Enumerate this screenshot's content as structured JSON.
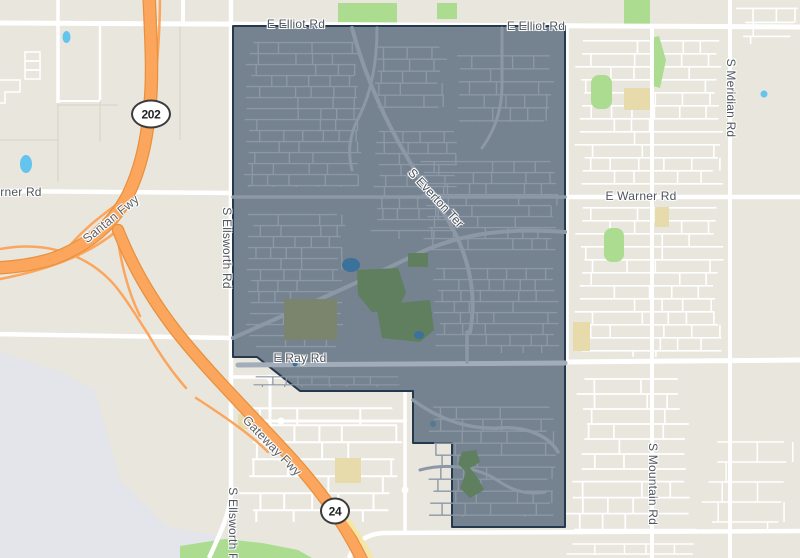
{
  "title": "Map with highlighted boundary area",
  "map": {
    "width": 800,
    "height": 558,
    "colors": {
      "base": "#e9e6de",
      "airport_gray": "#e4e5ea",
      "road_white": "#ffffff",
      "parcel_line": "#d9d5c9",
      "park_green": "#abdc90",
      "school_tan": "#e8dbab",
      "water_blue": "#63c4ee",
      "freeway_fill": "#fba65c",
      "freeway_casing": "#e8913d",
      "yellow_road": "#f6e7a0",
      "boundary_fill": "rgba(77,96,117,0.75)",
      "boundary_stroke": "#24384e",
      "inner_street": "#8c98a5",
      "inner_road_major": "#a2adb9",
      "inner_park": "#5f7f5f",
      "inner_park_olive": "#7b856e",
      "inner_pond": "#3b719a"
    },
    "boundary": {
      "name": "highlighted-district-boundary",
      "points": [
        [
          233,
          26
        ],
        [
          565,
          26
        ],
        [
          565,
          527
        ],
        [
          452,
          527
        ],
        [
          452,
          443
        ],
        [
          413,
          443
        ],
        [
          413,
          391
        ],
        [
          300,
          391
        ],
        [
          257,
          357
        ],
        [
          233,
          357
        ]
      ]
    },
    "labels": [
      {
        "id": "road-label-e-elliot-rd-west",
        "text": "E Elliot Rd",
        "x": 296,
        "y": 24,
        "rot": 0,
        "kind": "road"
      },
      {
        "id": "road-label-e-elliot-rd-east",
        "text": "E Elliot Rd",
        "x": 536,
        "y": 26,
        "rot": 0,
        "kind": "road"
      },
      {
        "id": "road-label-warner-rd-west",
        "text": "Warner Rd",
        "x": 12,
        "y": 192,
        "rot": 0,
        "kind": "road"
      },
      {
        "id": "road-label-e-warner-rd",
        "text": "E Warner Rd",
        "x": 641,
        "y": 196,
        "rot": 0,
        "kind": "road"
      },
      {
        "id": "road-label-e-ray-rd",
        "text": "E Ray Rd",
        "x": 300,
        "y": 358,
        "rot": 0,
        "kind": "road"
      },
      {
        "id": "road-label-s-everton-ter",
        "text": "S Everton Ter",
        "x": 436,
        "y": 198,
        "rot": 47,
        "kind": "road"
      },
      {
        "id": "freeway-label-santan-fwy",
        "text": "Santan Fwy",
        "x": 111,
        "y": 219,
        "rot": -39,
        "kind": "freeway"
      },
      {
        "id": "freeway-label-gateway-fwy",
        "text": "Gateway Fwy",
        "x": 272,
        "y": 446,
        "rot": 46,
        "kind": "freeway"
      },
      {
        "id": "road-label-s-ellsworth-rd-mid",
        "text": "S Ellsworth Rd",
        "x": 227,
        "y": 248,
        "rot": 0,
        "kind": "road",
        "vertical": true
      },
      {
        "id": "road-label-s-ellsworth-rd-south",
        "text": "S Ellsworth Rd",
        "x": 233,
        "y": 528,
        "rot": 0,
        "kind": "road",
        "vertical": true
      },
      {
        "id": "road-label-s-meridian-rd",
        "text": "S Meridian Rd",
        "x": 731,
        "y": 98,
        "rot": 0,
        "kind": "road",
        "vertical": true
      },
      {
        "id": "road-label-s-mountain-rd",
        "text": "S Mountain Rd",
        "x": 653,
        "y": 484,
        "rot": 0,
        "kind": "road",
        "vertical": true
      }
    ],
    "shields": [
      {
        "id": "route-shield-202",
        "text": "202",
        "x": 151,
        "y": 114,
        "w": 40,
        "h": 29
      },
      {
        "id": "route-shield-24",
        "text": "24",
        "x": 335,
        "y": 511,
        "w": 30,
        "h": 27
      }
    ],
    "airport_area": {
      "points": [
        [
          0,
          352
        ],
        [
          60,
          372
        ],
        [
          95,
          390
        ],
        [
          120,
          480
        ],
        [
          167,
          527
        ],
        [
          215,
          535
        ],
        [
          240,
          545
        ],
        [
          240,
          558
        ],
        [
          0,
          558
        ]
      ]
    },
    "parks": [
      {
        "type": "rect",
        "x": 338,
        "y": 3,
        "w": 59,
        "h": 20
      },
      {
        "type": "rect",
        "x": 437,
        "y": 3,
        "w": 20,
        "h": 16
      },
      {
        "type": "rect",
        "x": 624,
        "y": 0,
        "w": 26,
        "h": 25
      },
      {
        "type": "rect",
        "x": 591,
        "y": 75,
        "w": 21,
        "h": 34,
        "r": 8
      },
      {
        "type": "poly",
        "points": [
          [
            651,
            38
          ],
          [
            659,
            36
          ],
          [
            666,
            60
          ],
          [
            660,
            88
          ],
          [
            653,
            86
          ]
        ]
      },
      {
        "type": "rect",
        "x": 604,
        "y": 228,
        "w": 20,
        "h": 34,
        "r": 8
      },
      {
        "type": "poly",
        "points": [
          [
            180,
            546
          ],
          [
            225,
            539
          ],
          [
            262,
            543
          ],
          [
            298,
            550
          ],
          [
            312,
            558
          ],
          [
            180,
            558
          ]
        ]
      }
    ],
    "schools": [
      {
        "x": 624,
        "y": 88,
        "w": 26,
        "h": 22
      },
      {
        "x": 655,
        "y": 207,
        "w": 14,
        "h": 20
      },
      {
        "x": 573,
        "y": 322,
        "w": 17,
        "h": 29
      },
      {
        "x": 335,
        "y": 458,
        "w": 26,
        "h": 25
      },
      {
        "x": 238,
        "y": 414,
        "w": 19,
        "h": 15
      }
    ],
    "water": [
      {
        "x": 66.5,
        "y": 37,
        "rx": 4,
        "ry": 6
      },
      {
        "x": 26,
        "y": 164,
        "rx": 6,
        "ry": 9
      },
      {
        "x": 764,
        "y": 94,
        "rx": 3.5,
        "ry": 3.5
      },
      {
        "x": 433,
        "y": 424,
        "rx": 3,
        "ry": 3
      }
    ],
    "parcel_lines": [
      "M58,103 L58,182",
      "M58,105 L118,105",
      "M100,100 L100,142",
      "M180,24 L180,140",
      "M0,140 L58,140"
    ],
    "structures": [
      {
        "type": "rect",
        "x": 25,
        "y": 52,
        "w": 15,
        "h": 9
      },
      {
        "type": "rect",
        "x": 25,
        "y": 61,
        "w": 15,
        "h": 9
      },
      {
        "type": "rect",
        "x": 25,
        "y": 70,
        "w": 15,
        "h": 9
      },
      {
        "type": "path",
        "d": "M0,80 L20,80 L20,92 L5,92 L5,103 L0,103"
      }
    ],
    "roads": [
      {
        "d": "M-5,23 L805,27",
        "w": 5
      },
      {
        "d": "M-5,191 L233,193",
        "w": 4.5
      },
      {
        "d": "M565,197 L805,197",
        "w": 4.5
      },
      {
        "d": "M-5,334 L233,338",
        "w": 4.5
      },
      {
        "d": "M565,362 L805,360",
        "w": 5
      },
      {
        "d": "M805,531 L383,533 C366,534 354,543 349,558",
        "w": 4.5
      },
      {
        "d": "M231,-5 L231,490 C231,510 222,530 209,558",
        "w": 4.5
      },
      {
        "d": "M58,-5 L58,103",
        "w": 3.5
      },
      {
        "d": "M100,24 L100,100",
        "w": 2.5
      },
      {
        "d": "M58,101 L100,101",
        "w": 2
      },
      {
        "d": "M183,-5 L183,24",
        "w": 4
      },
      {
        "d": "M652,28 L652,558",
        "w": 4
      },
      {
        "d": "M730,-5 L730,558",
        "w": 4
      },
      {
        "d": "M567,28 L567,362",
        "w": 3.5
      },
      {
        "d": "M270,377 L270,452",
        "w": 3
      },
      {
        "d": "M233,377 L330,377",
        "w": 3.5
      },
      {
        "d": "M252,421 L407,421",
        "w": 3
      },
      {
        "d": "M405,390 L405,531",
        "w": 3.5
      }
    ],
    "roundabouts": [
      [
        270,
        378
      ],
      [
        281,
        421
      ],
      [
        405,
        490
      ]
    ],
    "ramps": [
      "M128,196 C104,214 80,230 60,258",
      "M118,230 C94,250 60,268 -5,280",
      "M-5,250 C50,238 95,258 120,292 C132,308 140,322 148,334",
      "M116,226 C120,260 128,292 140,316",
      "M196,398 C230,420 252,436 268,452",
      "M160,-5 C160,40 156,80 152,105",
      "M148,334 C160,355 172,372 186,388"
    ],
    "freeways": [
      {
        "id": "santan-fwy",
        "d": "M149,-5 C151,40 153,75 150,105 C147,140 141,168 128,195 C112,226 88,245 55,258 C37,264 18,267 -5,268",
        "w": 11
      },
      {
        "id": "gateway-fwy",
        "d": "M118,230 C133,268 152,300 176,331 C205,368 243,406 281,447 C311,479 342,517 363,562",
        "w": 10
      }
    ],
    "yellow_roads": [
      {
        "d": "M342,512 C355,530 366,545 373,562",
        "w": 4
      }
    ],
    "grids_outside": [
      {
        "x": 574,
        "y": 33,
        "w": 150,
        "h": 152,
        "gap": 13,
        "lw": 1.6
      },
      {
        "x": 735,
        "y": 0,
        "w": 65,
        "h": 45,
        "gap": 14,
        "lw": 1.6
      },
      {
        "x": 574,
        "y": 200,
        "w": 150,
        "h": 158,
        "gap": 13,
        "lw": 1.6
      },
      {
        "x": 575,
        "y": 370,
        "w": 115,
        "h": 100,
        "gap": 15,
        "lw": 1.7
      },
      {
        "x": 562,
        "y": 472,
        "w": 135,
        "h": 58,
        "gap": 16,
        "lw": 1.7
      },
      {
        "x": 700,
        "y": 430,
        "w": 95,
        "h": 100,
        "gap": 20,
        "lw": 1.5
      },
      {
        "x": 238,
        "y": 398,
        "w": 165,
        "h": 125,
        "gap": 17,
        "lw": 2
      },
      {
        "x": 565,
        "y": 538,
        "w": 130,
        "h": 18,
        "gap": 10,
        "lw": 1.5
      }
    ],
    "inner": {
      "grids": [
        {
          "x": 244,
          "y": 36,
          "w": 118,
          "h": 152,
          "gap": 11,
          "lw": 1.4
        },
        {
          "x": 368,
          "y": 40,
          "w": 80,
          "h": 75,
          "gap": 12,
          "lw": 1.4
        },
        {
          "x": 246,
          "y": 208,
          "w": 100,
          "h": 140,
          "gap": 11,
          "lw": 1.4
        },
        {
          "x": 370,
          "y": 125,
          "w": 90,
          "h": 115,
          "gap": 11,
          "lw": 1.4
        },
        {
          "x": 455,
          "y": 48,
          "w": 100,
          "h": 75,
          "gap": 13,
          "lw": 1.4
        },
        {
          "x": 420,
          "y": 155,
          "w": 140,
          "h": 95,
          "gap": 11,
          "lw": 1.4
        },
        {
          "x": 430,
          "y": 262,
          "w": 130,
          "h": 92,
          "gap": 11,
          "lw": 1.4
        },
        {
          "x": 425,
          "y": 400,
          "w": 132,
          "h": 118,
          "gap": 12,
          "lw": 1.4
        },
        {
          "x": 252,
          "y": 372,
          "w": 150,
          "h": 16,
          "gap": 8,
          "lw": 1.2
        }
      ],
      "roads": [
        {
          "d": "M238,365 L565,363",
          "w": 5,
          "major": true
        },
        {
          "d": "M233,197 L565,197",
          "w": 3.5
        },
        {
          "d": "M352,28 C370,95 400,150 432,196 C452,224 462,244 468,268 C474,292 474,312 470,332",
          "w": 4
        },
        {
          "d": "M233,338 C300,308 360,282 415,255 C462,232 510,228 565,232",
          "w": 4
        },
        {
          "d": "M377,28 C377,60 372,90 360,115 C350,133 347,150 352,170",
          "w": 3
        },
        {
          "d": "M502,28 L502,85 C502,110 495,130 482,148",
          "w": 3
        },
        {
          "d": "M467,332 L467,362",
          "w": 3.5
        },
        {
          "d": "M413,400 C440,420 470,430 500,428 C530,426 550,438 558,452",
          "w": 3.5
        },
        {
          "d": "M420,470 C450,462 480,468 500,482 C515,492 530,495 545,492",
          "w": 3
        }
      ],
      "parks": [
        {
          "type": "poly",
          "points": [
            [
              357,
              270
            ],
            [
              398,
              268
            ],
            [
              406,
              292
            ],
            [
              398,
              310
            ],
            [
              372,
              312
            ],
            [
              358,
              295
            ]
          ],
          "fill": "inner_park"
        },
        {
          "type": "rect",
          "x": 284,
          "y": 299,
          "w": 53,
          "h": 41,
          "fill": "inner_park_olive"
        },
        {
          "type": "poly",
          "points": [
            [
              376,
              305
            ],
            [
              430,
              300
            ],
            [
              434,
              330
            ],
            [
              420,
              342
            ],
            [
              382,
              338
            ]
          ],
          "fill": "inner_park"
        },
        {
          "type": "rect",
          "x": 408,
          "y": 253,
          "w": 20,
          "h": 14,
          "fill": "inner_park"
        },
        {
          "type": "poly",
          "points": [
            [
              462,
              452
            ],
            [
              476,
              450
            ],
            [
              480,
              462
            ],
            [
              470,
              468
            ],
            [
              478,
              478
            ],
            [
              484,
              490
            ],
            [
              470,
              498
            ],
            [
              460,
              488
            ],
            [
              466,
              472
            ],
            [
              458,
              464
            ]
          ],
          "fill": "inner_park"
        }
      ],
      "ponds": [
        {
          "x": 351,
          "y": 265,
          "rx": 9,
          "ry": 7
        },
        {
          "x": 419,
          "y": 335,
          "rx": 5,
          "ry": 4
        },
        {
          "x": 295,
          "y": 364,
          "rx": 2.5,
          "ry": 2.5
        }
      ]
    }
  }
}
